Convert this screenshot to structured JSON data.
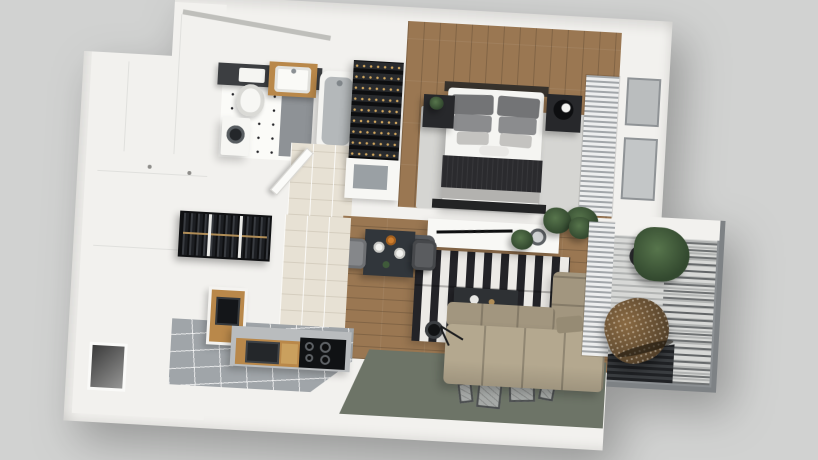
{
  "scene": {
    "type": "3d-floor-plan-render",
    "view": "top-down isometric",
    "subject": "one-bedroom apartment with balcony",
    "visible_text": "none"
  },
  "palette": {
    "bg": "#d1d2d1",
    "wall": "#f2f1ee",
    "wood": "#9a7752",
    "tileBeige": "#e7e1d4",
    "tileGray": "#a0a5a9",
    "rugBedroom": "#d5d5d2",
    "stripeDark": "#232327",
    "stripeLight": "#eceae6",
    "dark": "#27282b",
    "blanket": "#2b2b2e",
    "sofa": "#b4a88f",
    "sofaDark": "#a2967f",
    "greenFloor": "#6d7467",
    "woodCabinet": "#b9884a",
    "blindGray": "#a2a6a9",
    "slatLight": "#d7d8d6",
    "slatGap": "#b2b4b3",
    "frameFill": "#a6a9a7",
    "frameEdge": "#4c4f50",
    "plant": "#33492f",
    "plantLight": "#57754c",
    "rattan": "#60492e",
    "brassRail": "#b08d57",
    "bottleGlint": "#d2a75e",
    "orangeDish": "#d07f2d",
    "tubInner": "#b4b8ba",
    "shower": "#8e9296"
  },
  "rooms": {
    "bathroom": {
      "label": "Bathroom",
      "items": [
        "toilet",
        "wood vanity with sink",
        "bathtub",
        "washing machine",
        "shower mat",
        "dotted tile floor"
      ]
    },
    "hallway": {
      "label": "Hallway and wardrobes",
      "items": [
        "entry niche",
        "white cabinet fronts",
        "open wardrobe with hanging clothes",
        "white door ajar"
      ]
    },
    "bedroom": {
      "label": "Bedroom",
      "items": [
        "double bed with dark throw",
        "gray pillows",
        "two dark nightstands",
        "round black lamp",
        "light rug",
        "striped curtains",
        "potted plant"
      ]
    },
    "living": {
      "label": "Living room",
      "items": [
        "white media console",
        "flat TV",
        "dark desk chair",
        "black and white striped rug",
        "dark coffee table",
        "beige corner sofa",
        "black floor lamp",
        "framed prints on green floor"
      ]
    },
    "dining": {
      "label": "Dining area",
      "items": [
        "dark table",
        "two gray chairs",
        "white plates",
        "orange dish"
      ]
    },
    "kitchen": {
      "label": "Kitchen",
      "items": [
        "white island",
        "open wood shelf with oven",
        "counter with induction hob",
        "wine rack",
        "gray tile floor",
        "beige tile floor"
      ]
    },
    "balcony": {
      "label": "Balcony",
      "items": [
        "hanging rattan egg chair",
        "potted tree",
        "slatted deck",
        "dark deck mat",
        "railing"
      ]
    }
  }
}
